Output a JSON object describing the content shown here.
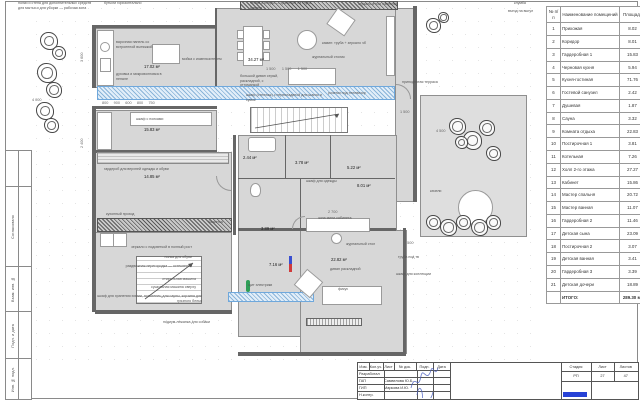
{
  "sheet": {
    "side_stamp": [
      "Согласовано",
      "Взам. инв. №",
      "Подп. и дата",
      "Инв. № подл."
    ]
  },
  "room_table": {
    "headers": [
      "№ п/п",
      "Наименование помещений",
      "Площадь"
    ],
    "rows": [
      {
        "n": "1",
        "name": "Прихожая",
        "area": "8.02"
      },
      {
        "n": "2",
        "name": "Коридор",
        "area": "8.01"
      },
      {
        "n": "3",
        "name": "Гардеробная 1",
        "area": "15.83"
      },
      {
        "n": "4",
        "name": "Черновая кухня",
        "area": "5.94"
      },
      {
        "n": "5",
        "name": "Кухня-гостиная",
        "area": "71.76"
      },
      {
        "n": "6",
        "name": "Гостевой санузел",
        "area": "2.42"
      },
      {
        "n": "7",
        "name": "Душевая",
        "area": "1.87"
      },
      {
        "n": "8",
        "name": "Сауна",
        "area": "3.32"
      },
      {
        "n": "9",
        "name": "Комната отдыха",
        "area": "22.83"
      },
      {
        "n": "10",
        "name": "Постирочная 1",
        "area": "3.81"
      },
      {
        "n": "11",
        "name": "Котельная",
        "area": "7.26"
      },
      {
        "n": "12",
        "name": "Холл 2-го этажа",
        "area": "27.27"
      },
      {
        "n": "13",
        "name": "Кабинет",
        "area": "15.86"
      },
      {
        "n": "14",
        "name": "Мастер спальня",
        "area": "20.72"
      },
      {
        "n": "15",
        "name": "Мастер ванная",
        "area": "11.07"
      },
      {
        "n": "16",
        "name": "Гардеробная 2",
        "area": "11.46"
      },
      {
        "n": "17",
        "name": "Детская сына",
        "area": "23.09"
      },
      {
        "n": "18",
        "name": "Постирочная 2",
        "area": "3.07"
      },
      {
        "n": "19",
        "name": "Детская ванная",
        "area": "3.41"
      },
      {
        "n": "20",
        "name": "Гардеробная 3",
        "area": "3.39"
      },
      {
        "n": "21",
        "name": "Детская дочери",
        "area": "18.89"
      }
    ],
    "total_label": "ИТОГО:",
    "total_value": "289.30 м²"
  },
  "title_block": {
    "cols": [
      "Изм.",
      "Кол.уч.",
      "Лист",
      "№ док.",
      "Подп.",
      "Дата"
    ],
    "rows": [
      {
        "role": "Разработал",
        "name": ""
      },
      {
        "role": "ГАП",
        "name": "Самвелова Ю.Б."
      },
      {
        "role": "ГИП",
        "name": "Маркова И.Ю."
      },
      {
        "role": "Н.контр.",
        "name": ""
      }
    ],
    "stage_label": "Стадия",
    "sheet_label": "Лист",
    "sheets_label": "Листов",
    "stage": "РП",
    "sheet": "27",
    "sheets": "47",
    "accent_color": "#2742d6"
  },
  "plan": {
    "labels": [
      {
        "x": 18,
        "y": 1,
        "w": 78,
        "t": "полки и стена для дополнительных средств для мытья и для уборки — рабочая зона",
        "c": "ann"
      },
      {
        "x": 104,
        "y": 1,
        "w": 52,
        "t": "бутыли горизонтально",
        "c": "ann"
      },
      {
        "x": 250,
        "y": 1,
        "w": 62,
        "t": "чехлы и пледы — хранение на глубь дивана",
        "c": "ann"
      },
      {
        "x": 358,
        "y": 2,
        "w": 42,
        "t": "зеркало в пол навесное",
        "c": "ann"
      },
      {
        "x": 514,
        "y": 1,
        "w": 30,
        "t": "клумба",
        "c": "ann"
      },
      {
        "x": 508,
        "y": 9,
        "w": 36,
        "t": "въезд на выгул",
        "c": "ann"
      },
      {
        "x": 116,
        "y": 40,
        "w": 48,
        "t": "варочная панель со встроенной вытяжкой",
        "c": "ann"
      },
      {
        "x": 116,
        "y": 72,
        "w": 52,
        "t": "духовка и микроволновка в пенале",
        "c": "ann"
      },
      {
        "x": 182,
        "y": 57,
        "w": 40,
        "t": "мойка с измельчителем",
        "c": "ann"
      },
      {
        "x": 322,
        "y": 41,
        "w": 52,
        "t": "камин: труба + зеркало чб",
        "c": "ann"
      },
      {
        "x": 312,
        "y": 55,
        "w": 40,
        "t": "журнальный столик",
        "c": "ann"
      },
      {
        "x": 240,
        "y": 74,
        "w": 40,
        "t": "большой диван серый, раскладной, с оттоманкой",
        "c": "ann"
      },
      {
        "x": 246,
        "y": 93,
        "w": 80,
        "t": "шкаф (стеллаж) с перекладиной для шапок и сумок",
        "c": "ann"
      },
      {
        "x": 328,
        "y": 91,
        "w": 46,
        "t": "розетки под телевизор",
        "c": "ann"
      },
      {
        "x": 402,
        "y": 80,
        "w": 38,
        "t": "приподнятая терраса",
        "c": "ann"
      },
      {
        "x": 430,
        "y": 189,
        "w": 22,
        "t": "качели",
        "c": "ann"
      },
      {
        "x": 398,
        "y": 255,
        "w": 34,
        "t": "труба под тв",
        "c": "ann"
      },
      {
        "x": 396,
        "y": 272,
        "w": 48,
        "t": "шкаф для коллекции",
        "c": "ann"
      },
      {
        "x": 136,
        "y": 117,
        "w": 42,
        "t": "шкаф с полками",
        "c": "ann"
      },
      {
        "x": 104,
        "y": 167,
        "w": 84,
        "t": "гардероб для верхней одежды и обуви",
        "c": "ann"
      },
      {
        "x": 106,
        "y": 212,
        "w": 42,
        "t": "кухонный проход",
        "c": "ann"
      },
      {
        "x": 208,
        "y": 220,
        "w": 26,
        "t": "банкетка",
        "c": "ann"
      },
      {
        "x": 306,
        "y": 179,
        "w": 40,
        "t": "шкаф для одежды",
        "c": "ann"
      },
      {
        "x": 318,
        "y": 216,
        "w": 50,
        "t": "зона мини-кабинета",
        "c": "ann"
      },
      {
        "x": 330,
        "y": 267,
        "w": 46,
        "t": "диван раскладной",
        "c": "ann"
      },
      {
        "x": 346,
        "y": 242,
        "w": 42,
        "t": "журнальный стол",
        "c": "ann"
      },
      {
        "x": 338,
        "y": 287,
        "w": 22,
        "t": "фикус",
        "c": "ann"
      },
      {
        "x": 248,
        "y": 283,
        "w": 36,
        "t": "щит электрики",
        "c": "ann"
      },
      {
        "x": 100,
        "y": 245,
        "w": 92,
        "t": "зеркало с подсветкой в полный рост",
        "c": "ann r"
      },
      {
        "x": 120,
        "y": 255,
        "w": 72,
        "t": "полка для обуви",
        "c": "ann r"
      },
      {
        "x": 100,
        "y": 264,
        "w": 92,
        "t": "раздвижная перегородка — остекление",
        "c": "ann r"
      },
      {
        "x": 112,
        "y": 277,
        "w": 84,
        "t": "стиральная машина",
        "c": "ann r"
      },
      {
        "x": 104,
        "y": 285,
        "w": 92,
        "t": "сушильная машина сверху",
        "c": "ann r"
      },
      {
        "x": 96,
        "y": 294,
        "w": 106,
        "t": "шкаф для хранения химии, полотенец для сауны, корзина для грязного белья",
        "c": "ann r"
      },
      {
        "x": 112,
        "y": 320,
        "w": 98,
        "t": "подиум-лежанка для собаки",
        "c": "ann r"
      },
      {
        "x": 144,
        "y": 64,
        "w": 26,
        "t": "17.02 м²",
        "c": "area"
      },
      {
        "x": 248,
        "y": 57,
        "w": 26,
        "t": "34.27 м²",
        "c": "area"
      },
      {
        "x": 144,
        "y": 127,
        "w": 26,
        "t": "15.83 м²",
        "c": "area"
      },
      {
        "x": 144,
        "y": 174,
        "w": 26,
        "t": "14.85 м²",
        "c": "area"
      },
      {
        "x": 243,
        "y": 155,
        "w": 22,
        "t": "2.44 м²",
        "c": "area"
      },
      {
        "x": 295,
        "y": 160,
        "w": 22,
        "t": "3.78 м²",
        "c": "area"
      },
      {
        "x": 347,
        "y": 165,
        "w": 22,
        "t": "5.22 м²",
        "c": "area"
      },
      {
        "x": 357,
        "y": 183,
        "w": 22,
        "t": "8.01 м²",
        "c": "area"
      },
      {
        "x": 261,
        "y": 226,
        "w": 22,
        "t": "3.89 м²",
        "c": "area"
      },
      {
        "x": 269,
        "y": 262,
        "w": 22,
        "t": "7.16 м²",
        "c": "area"
      },
      {
        "x": 331,
        "y": 257,
        "w": 26,
        "t": "22.82 м²",
        "c": "area"
      },
      {
        "x": 266,
        "y": 67,
        "w": 74,
        "t": "1 500      1 500      1 500",
        "c": "dim"
      },
      {
        "x": 102,
        "y": 101,
        "w": 128,
        "t": "800     900     600     800     750",
        "c": "dim"
      },
      {
        "x": 32,
        "y": 98,
        "w": 26,
        "t": "4 000",
        "c": "dim"
      },
      {
        "x": 436,
        "y": 129,
        "w": 28,
        "t": "4 500",
        "c": "dim"
      },
      {
        "x": 400,
        "y": 110,
        "w": 24,
        "t": "1 500",
        "c": "dim"
      },
      {
        "x": 404,
        "y": 241,
        "w": 24,
        "t": "1 500",
        "c": "dim"
      },
      {
        "x": 328,
        "y": 210,
        "w": 24,
        "t": "2 700",
        "c": "dim"
      },
      {
        "x": 80,
        "y": 62,
        "w": 24,
        "t": "3 600",
        "c": "dim v"
      },
      {
        "x": 80,
        "y": 148,
        "w": 24,
        "t": "2 400",
        "c": "dim v"
      }
    ],
    "trees": [
      {
        "x": 40,
        "y": 32,
        "s": 16
      },
      {
        "x": 52,
        "y": 46,
        "s": 12
      },
      {
        "x": 37,
        "y": 63,
        "s": 18
      },
      {
        "x": 46,
        "y": 82,
        "s": 14
      },
      {
        "x": 36,
        "y": 102,
        "s": 16
      },
      {
        "x": 44,
        "y": 118,
        "s": 13
      },
      {
        "x": 426,
        "y": 18,
        "s": 13
      },
      {
        "x": 438,
        "y": 12,
        "s": 9
      },
      {
        "x": 449,
        "y": 118,
        "s": 15
      },
      {
        "x": 463,
        "y": 131,
        "s": 17
      },
      {
        "x": 479,
        "y": 120,
        "s": 14
      },
      {
        "x": 486,
        "y": 146,
        "s": 13
      },
      {
        "x": 455,
        "y": 136,
        "s": 11
      },
      {
        "x": 426,
        "y": 215,
        "s": 13
      },
      {
        "x": 440,
        "y": 219,
        "s": 15
      },
      {
        "x": 456,
        "y": 215,
        "s": 13
      },
      {
        "x": 471,
        "y": 219,
        "s": 15
      },
      {
        "x": 486,
        "y": 215,
        "s": 13
      }
    ]
  }
}
